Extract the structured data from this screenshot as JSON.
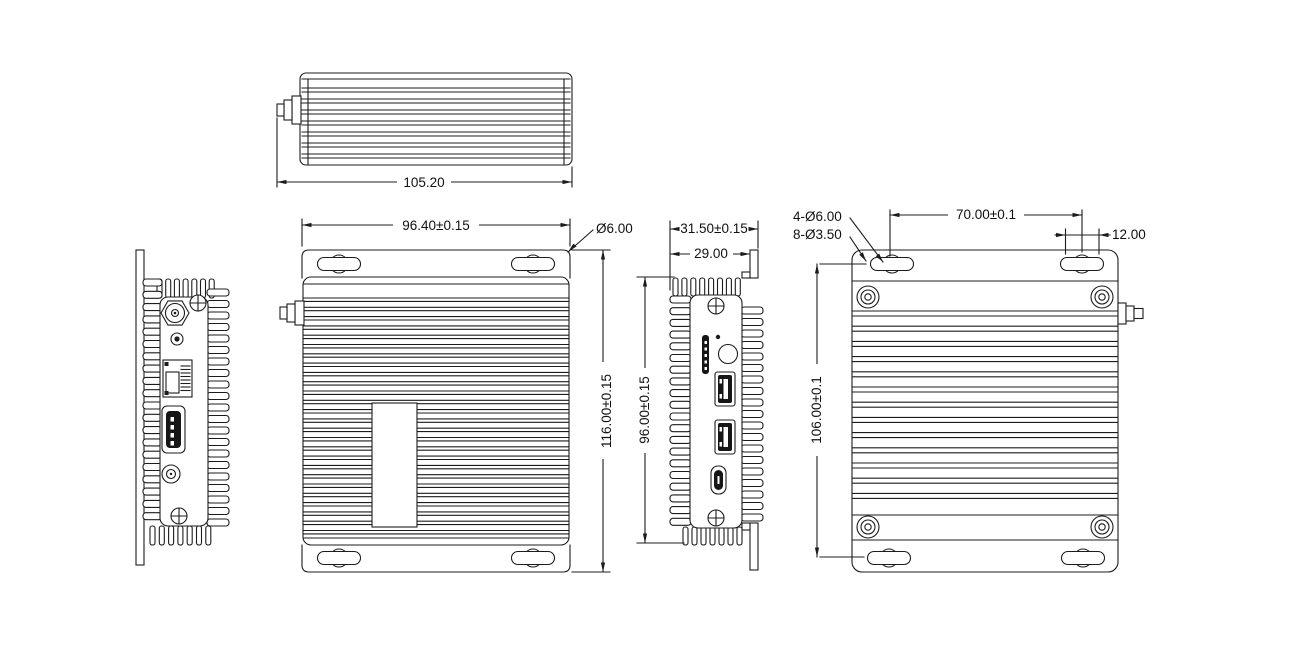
{
  "drawing": {
    "colors": {
      "background": "#ffffff",
      "line": "#1c1c1c"
    },
    "top_view": {
      "length": "105.20"
    },
    "front_view": {
      "width": "96.40±0.15",
      "height": "116.00±0.15",
      "mount_hole_dia": "Ø6.00"
    },
    "side_view": {
      "depth_overall": "31.50±0.15",
      "depth_body": "29.00",
      "body_height": "96.00±0.15"
    },
    "rear_view": {
      "hole_note_large": "4-Ø6.00",
      "hole_note_small": "8-Ø3.50",
      "hole_spacing_horizontal": "70.00±0.1",
      "slot_length": "12.00",
      "hole_spacing_vertical": "106.00±0.1"
    }
  }
}
